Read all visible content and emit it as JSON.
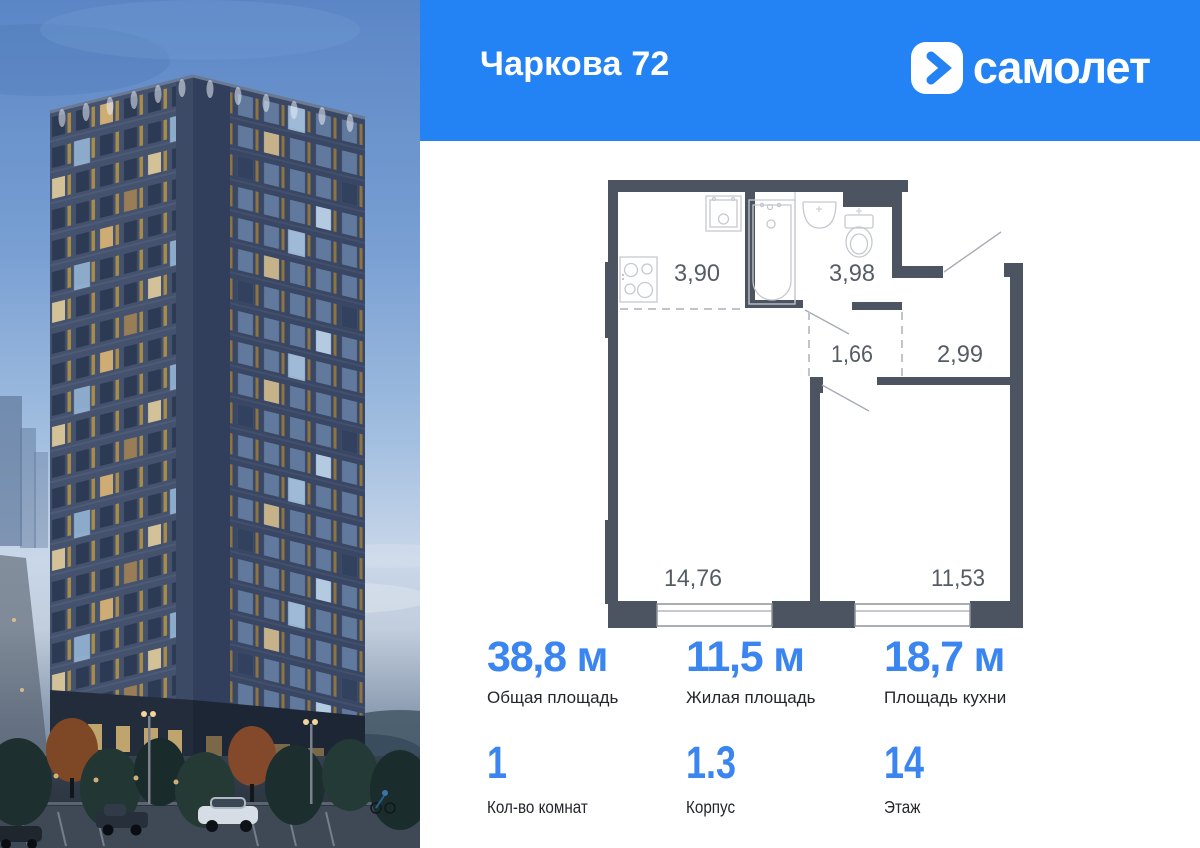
{
  "header": {
    "title": "Чаркова 72",
    "brand": "самолет"
  },
  "colors": {
    "header_blue": "#2383f4",
    "stat_value_blue": "#3a85f0",
    "plan_wall": "#4d5461"
  },
  "plan": {
    "rooms": [
      {
        "name": "kitchen-zone",
        "area": "3,90"
      },
      {
        "name": "bathroom",
        "area": "3,98"
      },
      {
        "name": "hallway",
        "area": "1,66"
      },
      {
        "name": "entry-hall",
        "area": "2,99"
      },
      {
        "name": "living-room",
        "area": "14,76"
      },
      {
        "name": "kitchen-living-room",
        "area": "11,53"
      }
    ]
  },
  "stats": {
    "row1": [
      {
        "value": "38,8 м",
        "label": "Общая площадь"
      },
      {
        "value": "11,5 м",
        "label": "Жилая площадь"
      },
      {
        "value": "18,7 м",
        "label": "Площадь кухни"
      }
    ],
    "row2": [
      {
        "value": "1",
        "label": "Кол-во комнат"
      },
      {
        "value": "1.3",
        "label": "Корпус"
      },
      {
        "value": "14",
        "label": "Этаж"
      }
    ]
  }
}
